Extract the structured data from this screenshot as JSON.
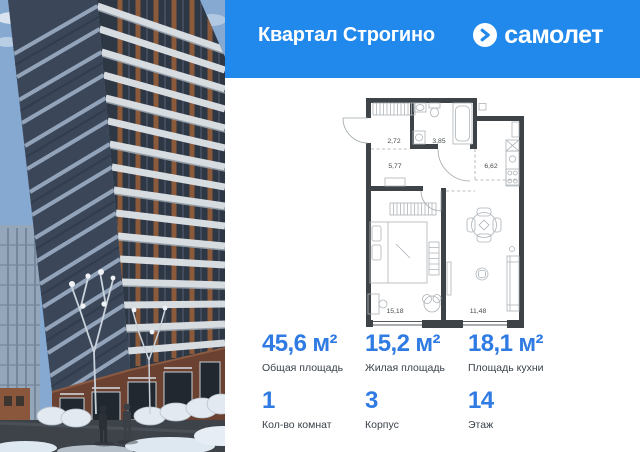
{
  "header": {
    "project_title": "Квартал Строгино",
    "brand_name": "самолет",
    "bg_color": "#2189EC"
  },
  "floor_plan": {
    "wall_color": "#3E4347",
    "rooms": [
      {
        "id": "entry-hall",
        "area": "2,72"
      },
      {
        "id": "bathroom",
        "area": "3,85"
      },
      {
        "id": "hallway",
        "area": "5,77"
      },
      {
        "id": "kitchen",
        "area": "6,62"
      },
      {
        "id": "bedroom",
        "area": "15,18"
      },
      {
        "id": "living-room",
        "area": "11,48"
      }
    ]
  },
  "stats": {
    "accent_color": "#2F7BE3",
    "label_color": "#3A414B",
    "items": [
      {
        "value": "45,6 м²",
        "label": "Общая площадь"
      },
      {
        "value": "15,2 м²",
        "label": "Жилая площадь"
      },
      {
        "value": "18,1 м²",
        "label": "Площадь кухни"
      },
      {
        "value": "1",
        "label": "Кол-во комнат"
      },
      {
        "value": "3",
        "label": "Корпус"
      },
      {
        "value": "14",
        "label": "Этаж"
      }
    ]
  }
}
